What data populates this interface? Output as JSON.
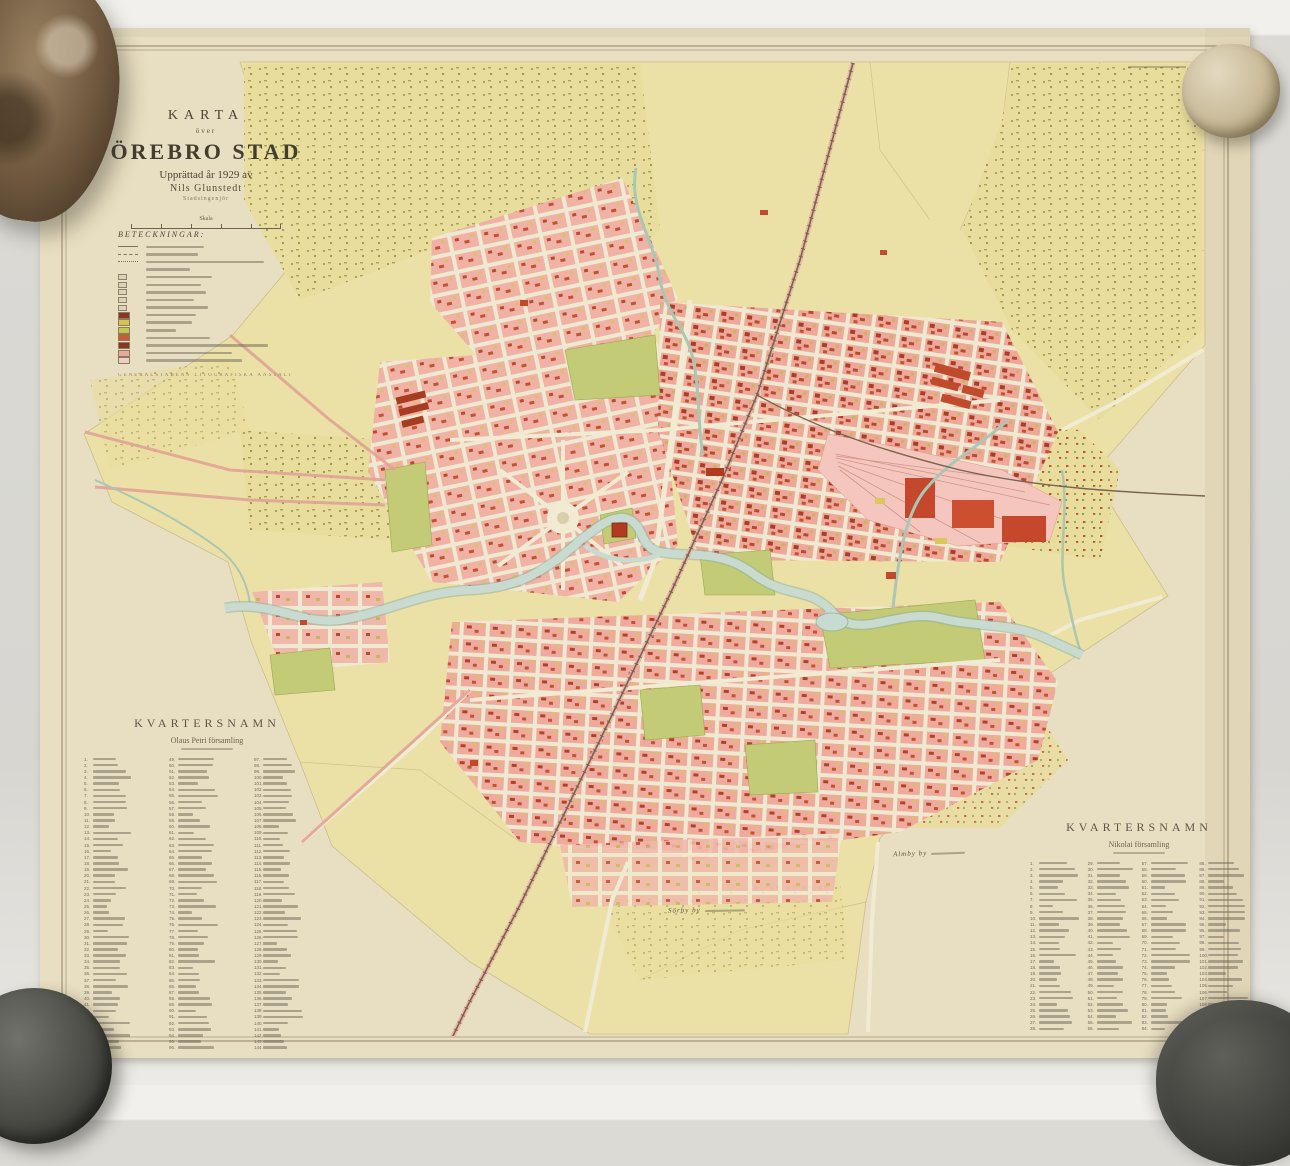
{
  "title_block": {
    "karta": "KARTA",
    "over": "över",
    "city": "ÖREBRO STAD",
    "line4": "Upprättad år 1929 av",
    "line5": "Nils Glunstedt",
    "line6": "Stadsingenjör",
    "scale": "Skala"
  },
  "legend": {
    "title": "BETECKNINGAR:",
    "imprint": "GENERALSTABENS LITOGRAFISKA ANSTALT",
    "rows": [
      {
        "sym": "line",
        "w": 58
      },
      {
        "sym": "dash",
        "w": 52
      },
      {
        "sym": "dot",
        "w": 118
      },
      {
        "sym": "none",
        "w": 44
      },
      {
        "sym": "mark",
        "w": 66
      },
      {
        "sym": "mark",
        "w": 55
      },
      {
        "sym": "mark",
        "w": 60
      },
      {
        "sym": "mark",
        "w": 48
      },
      {
        "sym": "mark",
        "w": 62
      },
      {
        "sym": "sw",
        "c": "#8e3424",
        "w": 50
      },
      {
        "sym": "sw",
        "c": "#d3c44f",
        "w": 46
      },
      {
        "sym": "sw",
        "c": "#c2c84e",
        "w": 30
      },
      {
        "sym": "sw",
        "c": "#cd5a36",
        "w": 64
      },
      {
        "sym": "sw",
        "c": "#8e3424",
        "w": 122
      },
      {
        "sym": "sw",
        "c": "#e9aa9e",
        "w": 86
      },
      {
        "sym": "sw",
        "c": "#f2cdc2",
        "w": 96
      }
    ]
  },
  "lists": {
    "left": {
      "title": "KVARTERSNAMN",
      "subtitle": "Olaus Petri församling",
      "columns": 3,
      "rows": 48
    },
    "right": {
      "title": "KVARTERSNAMN",
      "subtitle": "Nikolai församling",
      "columns": 4,
      "rows": 28
    }
  },
  "map_labels": [
    {
      "text": "Almby by"
    },
    {
      "text": "Sörby by"
    }
  ],
  "colors": {
    "sheet": "#e8dec1",
    "frame": "#8a795c",
    "map_yellow": "#ebe1a6",
    "block_pink": "#efb2a4",
    "block_red": "#bb4a2e",
    "park_green": "#c3cb76",
    "river": "#c7dacd",
    "yard_pink": "#f5c6bd",
    "rail": "#7c6250"
  }
}
